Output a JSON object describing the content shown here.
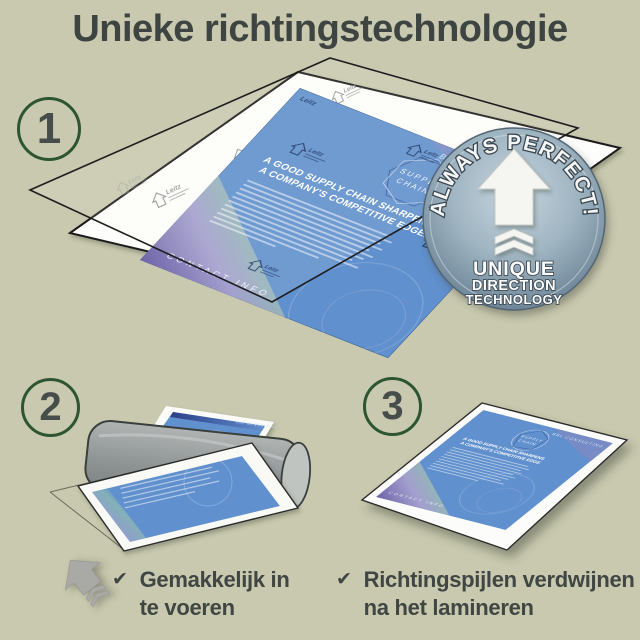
{
  "page": {
    "title": "Unieke richtingstechnologie",
    "background_color": "#c8c9ae",
    "text_color": "#3d4441",
    "step_circle_color": "#2d5531",
    "document_blue": "#6090cd",
    "badge_metal": "#8ba2b1"
  },
  "steps": [
    "1",
    "2",
    "3"
  ],
  "badge": {
    "arc_text": "ALWAYS PERFECT!",
    "line1": "UNIQUE",
    "line2": "DIRECTION",
    "line3": "TECHNOLOGY"
  },
  "document": {
    "brand": "BBL CONSULTING",
    "diagram_line1": "SUPPLY",
    "diagram_line2": "CHAIN",
    "headline_line1": "A GOOD SUPPLY CHAIN SHARPENS",
    "headline_line2": "A COMPANY'S COMPETITIVE EDGE.",
    "footer": "CONTACT INFO",
    "watermark": "Leitz"
  },
  "captions": [
    {
      "check": "✔",
      "line1": "Gemakkelijk in",
      "line2": "te voeren"
    },
    {
      "check": "✔",
      "line1": "Richtingspijlen verdwijnen",
      "line2": "na het lamineren"
    }
  ]
}
